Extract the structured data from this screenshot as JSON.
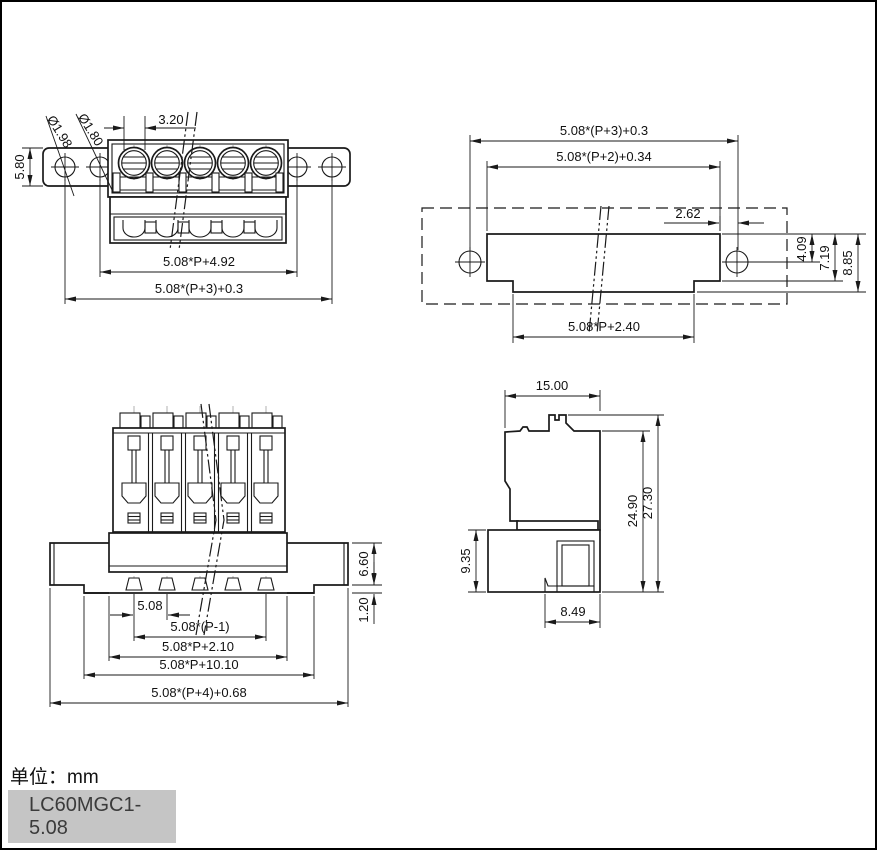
{
  "page": {
    "unit_label": "单位：mm",
    "part_number": "LC60MGC1-5.08"
  },
  "views": {
    "front_top": {
      "dims": {
        "flange_height": "5.80",
        "hole_diameter": "Ø1.98",
        "screw_hole_diameter": "Ø1.80",
        "screw_slot_width": "3.20",
        "hole_span": "5.08*P+4.92",
        "overall_width": "5.08*(P+3)+0.3"
      }
    },
    "top": {
      "dims": {
        "overall_width": "5.08*(P+3)+0.3",
        "body_width": "5.08*(P+2)+0.34",
        "hole_offset": "2.62",
        "hole_center_depth": "4.09",
        "body_depth": "7.19",
        "overall_depth": "8.85",
        "tongue_width": "5.08*P+2.40"
      }
    },
    "front_bottom": {
      "dims": {
        "flange_thickness": "6.60",
        "plate_thickness": "1.20",
        "pin_pitch": "5.08",
        "pin_span": "5.08*(P-1)",
        "body_width": "5.08*P+2.10",
        "step_width": "5.08*P+10.10",
        "overall_width": "5.08*(P+4)+0.68"
      }
    },
    "side": {
      "dims": {
        "top_width": "15.00",
        "body_height": "24.90",
        "overall_height": "27.30",
        "socket_height": "9.35",
        "socket_width": "8.49"
      }
    }
  }
}
